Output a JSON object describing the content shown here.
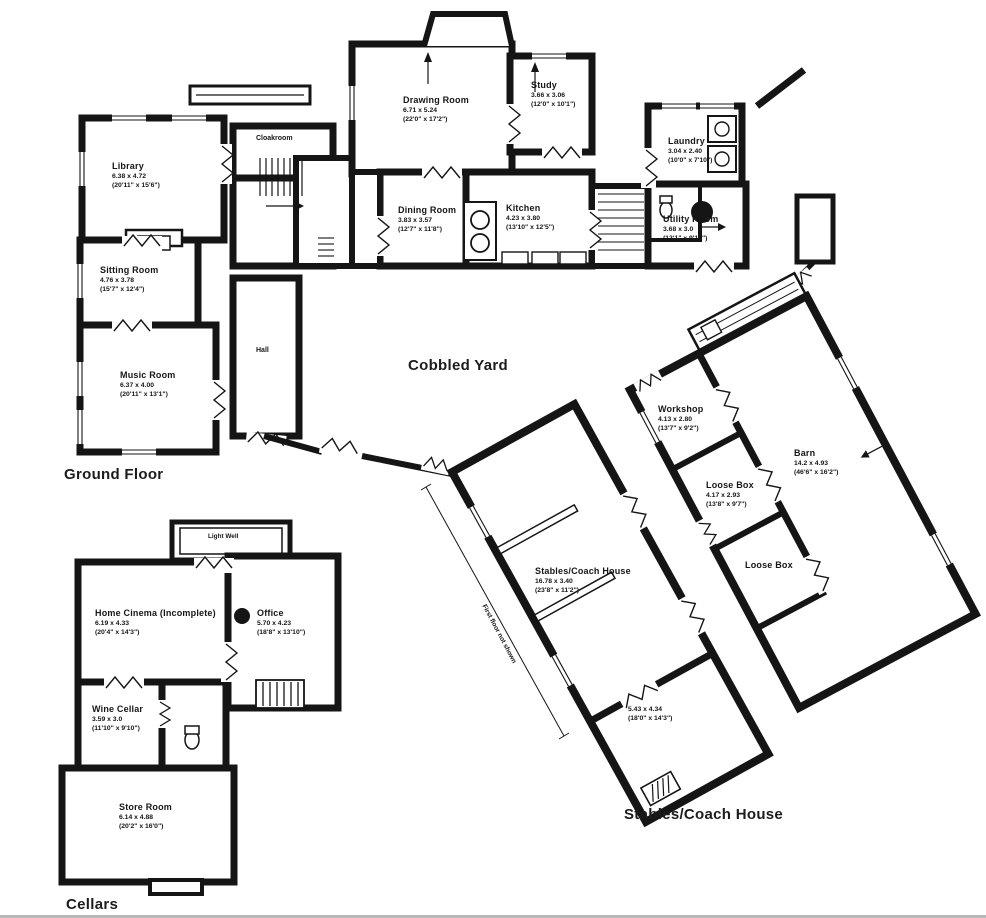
{
  "labels": {
    "ground_floor": "Ground Floor",
    "cobbled_yard": "Cobbled Yard",
    "cellars": "Cellars",
    "stables_section": "Stables/Coach House",
    "first_floor_note": "First floor not shown"
  },
  "colors": {
    "wall": "#151515",
    "background": "#ffffff"
  },
  "rooms": {
    "library": {
      "name": "Library",
      "m": "6.38 x 4.72",
      "ft": "(20'11\" x 15'6\")"
    },
    "sitting_room": {
      "name": "Sitting Room",
      "m": "4.76 x 3.78",
      "ft": "(15'7\" x 12'4\")"
    },
    "music_room": {
      "name": "Music Room",
      "m": "6.37 x 4.00",
      "ft": "(20'11\" x 13'1\")"
    },
    "cloakroom": {
      "name": "Cloakroom"
    },
    "hall": {
      "name": "Hall"
    },
    "drawing_room": {
      "name": "Drawing Room",
      "m": "6.71 x 5.24",
      "ft": "(22'0\" x 17'2\")"
    },
    "study": {
      "name": "Study",
      "m": "3.66 x 3.06",
      "ft": "(12'0\" x 10'1\")"
    },
    "dining_room": {
      "name": "Dining Room",
      "m": "3.83 x 3.57",
      "ft": "(12'7\" x 11'8\")"
    },
    "kitchen": {
      "name": "Kitchen",
      "m": "4.23 x 3.80",
      "ft": "(13'10\" x 12'5\")"
    },
    "laundry": {
      "name": "Laundry",
      "m": "3.04 x 2.40",
      "ft": "(10'0\" x 7'10\")"
    },
    "utility_room": {
      "name": "Utility Room",
      "m": "3.68 x 3.0",
      "ft": "(12'1\" x 9'10\")"
    },
    "workshop": {
      "name": "Workshop",
      "m": "4.13 x 2.80",
      "ft": "(13'7\" x 9'2\")"
    },
    "loose_box_1": {
      "name": "Loose Box",
      "m": "4.17 x 2.93",
      "ft": "(13'8\" x 9'7\")"
    },
    "loose_box_2": {
      "name": "Loose Box"
    },
    "barn": {
      "name": "Barn",
      "m": "14.2 x 4.93",
      "ft": "(46'6\" x 16'2\")"
    },
    "stables_coach_house": {
      "name": "Stables/Coach House",
      "m": "16.78 x 3.40",
      "ft": "(23'8\" x 11'2\")"
    },
    "stables_store": {
      "m": "5.43 x 4.34",
      "ft": "(18'0\" x 14'3\")"
    },
    "light_well": {
      "name": "Light Well"
    },
    "home_cinema": {
      "name": "Home Cinema (Incomplete)",
      "m": "6.19 x 4.33",
      "ft": "(20'4\" x 14'3\")"
    },
    "office": {
      "name": "Office",
      "m": "5.70 x 4.23",
      "ft": "(18'8\" x 13'10\")"
    },
    "wine_cellar": {
      "name": "Wine Cellar",
      "m": "3.59 x 3.0",
      "ft": "(11'10\" x 9'10\")"
    },
    "store_room": {
      "name": "Store Room",
      "m": "6.14 x 4.88",
      "ft": "(20'2\" x 16'0\")"
    }
  }
}
